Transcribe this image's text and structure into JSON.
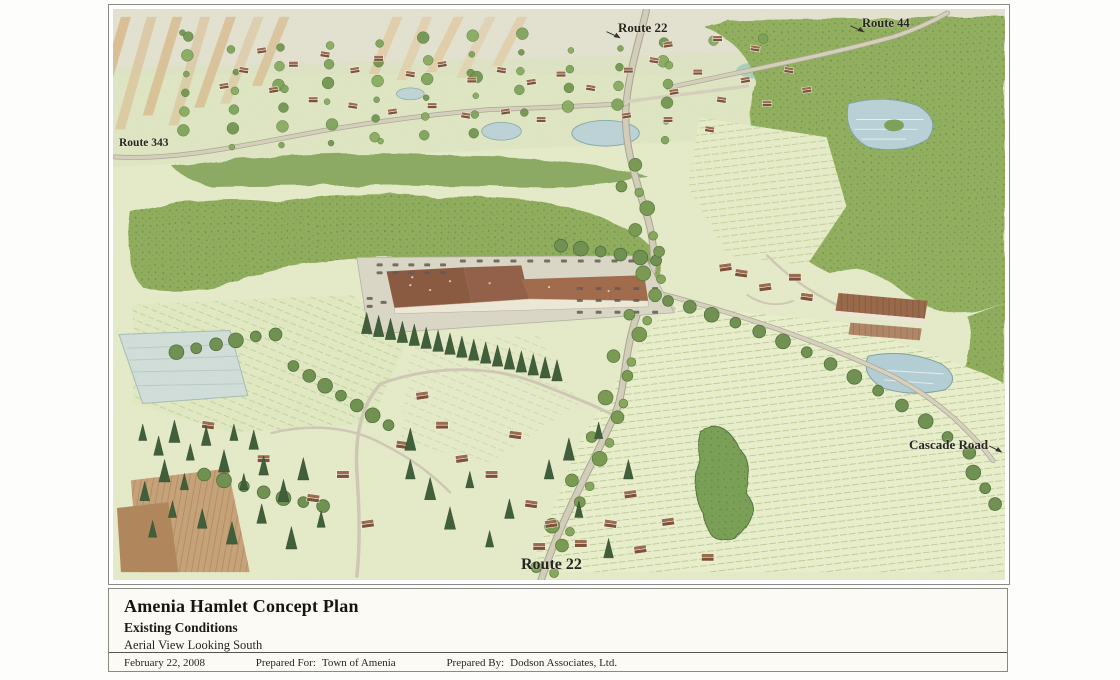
{
  "map": {
    "labels": {
      "route22_top": "Route 22",
      "route44": "Route 44",
      "route343": "Route 343",
      "cascade_road": "Cascade Road",
      "route22_bottom": "Route 22"
    },
    "colors": {
      "field_light": "#e6ecca",
      "field_rows": "#eaf0cd",
      "horizon": "#e4e2d0",
      "forest": "#92b05f",
      "forest_dark": "#7ca052",
      "tree": "#729a4e",
      "tree_stroke": "#4e7038",
      "conifer": "#3e5e39",
      "water": "#b9d2d8",
      "water_pale": "#d2dfda",
      "road": "#d4cfbb",
      "road_edge": "#aaa592",
      "roof": "#8a5a40",
      "roof_light": "#a26a4c",
      "barn": "#99684a",
      "parking": "#dbd8c8",
      "tan_field": "#d9bd90",
      "plow_brown": "#c7a379",
      "wall": "#efe9d8"
    }
  },
  "title_block": {
    "title": "Amenia Hamlet Concept Plan",
    "subtitle": "Existing Conditions",
    "view_line": "Aerial View Looking  South",
    "date": "February 22, 2008",
    "prepared_for_label": "Prepared For:",
    "prepared_for": "Town of Amenia",
    "prepared_by_label": "Prepared By:",
    "prepared_by": "Dodson Associates, Ltd."
  }
}
